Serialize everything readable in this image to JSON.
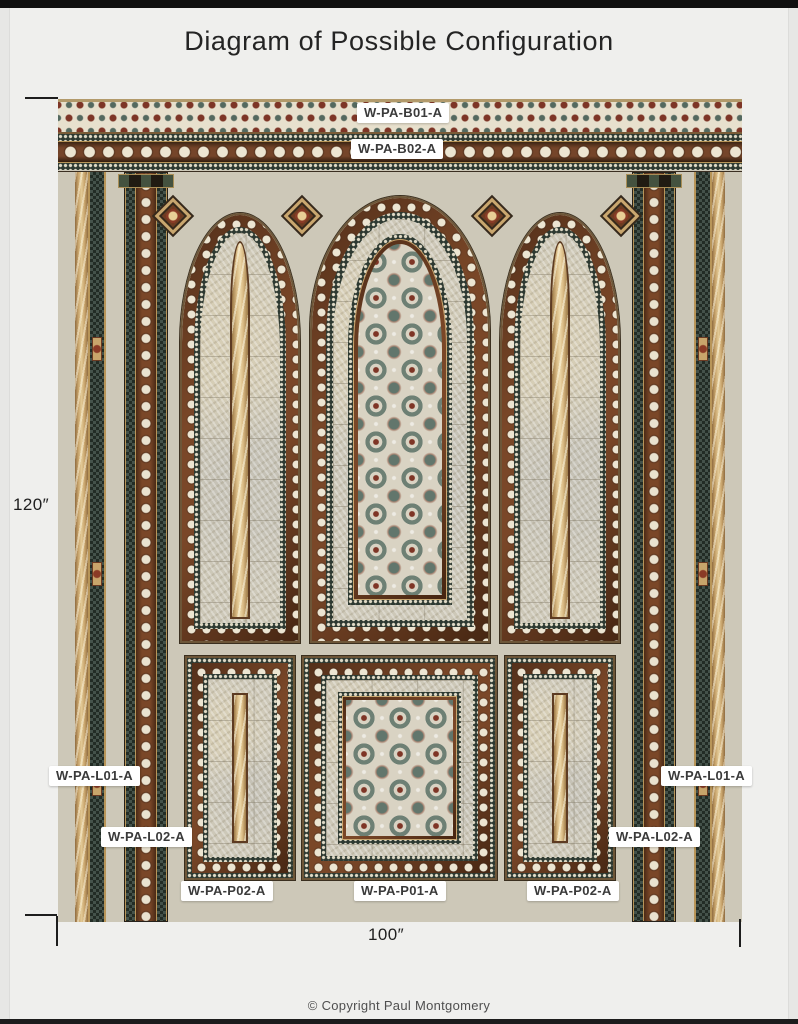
{
  "header": {
    "title": "Diagram of Possible Configuration"
  },
  "footer": {
    "copyright": "© Copyright Paul Montgomery"
  },
  "dims": {
    "height": "120″",
    "width": "100″"
  },
  "tags": {
    "b01": "W-PA-B01-A",
    "b02": "W-PA-B02-A",
    "l01_left": "W-PA-L01-A",
    "l02_left": "W-PA-L02-A",
    "l01_right": "W-PA-L01-A",
    "l02_right": "W-PA-L02-A",
    "p02_left": "W-PA-P02-A",
    "p01_center": "W-PA-P01-A",
    "p02_right": "W-PA-P02-A"
  },
  "palette": {
    "page_bg": "#efefed",
    "frame_bar": "#101010",
    "tile_mother_of_pearl": "#cdc8b8",
    "wood_brown": "#6e4126",
    "deep_green": "#2d3931",
    "pearl_cream": "#ece5d2",
    "accent_red": "#7d3526",
    "accent_teal": "#5d7268",
    "gold": "#c9a76f",
    "label_bg": "#ffffff",
    "label_text": "#3a3a3a"
  }
}
